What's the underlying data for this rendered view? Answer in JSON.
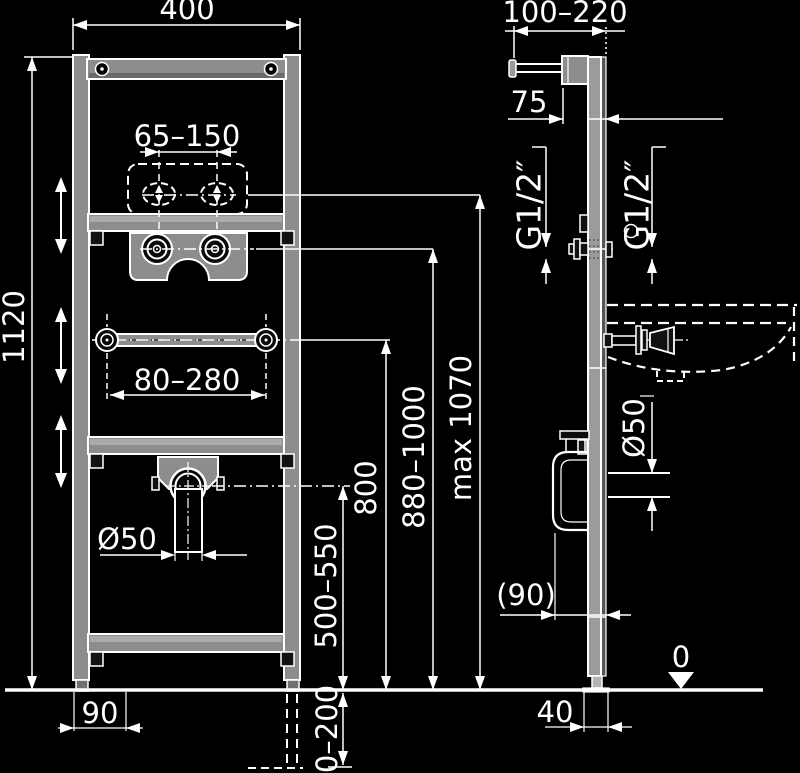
{
  "drawing": {
    "description": "Installation dimensional diagram of a wall-mounted washbasin mounting frame, front view and side view, on black background",
    "colors": {
      "background": "#000000",
      "line": "#ffffff",
      "metal": "#8d8d8d",
      "metal_dark": "#6a6a6a",
      "metal_light": "#aaaaaa"
    },
    "labels": {
      "front": {
        "width": "400",
        "height": "1120",
        "tap_spacing": "65–150",
        "rail_spacing": "80–280",
        "drain_diameter": "Ø50",
        "drain_height": "500–550",
        "anchor_width": "90",
        "leg_adjust": "0–200"
      },
      "side": {
        "depth_range": "100–220",
        "bracket_offset": "75",
        "water_left": "G1/2″",
        "water_right": "G1/2″",
        "tap_max_height": "max 1070",
        "rim_height": "880–1000",
        "rail_height": "800",
        "drain_diameter": "Ø50",
        "trap_depth": "(90)",
        "profile_width": "40",
        "floor_level": "0"
      }
    }
  }
}
